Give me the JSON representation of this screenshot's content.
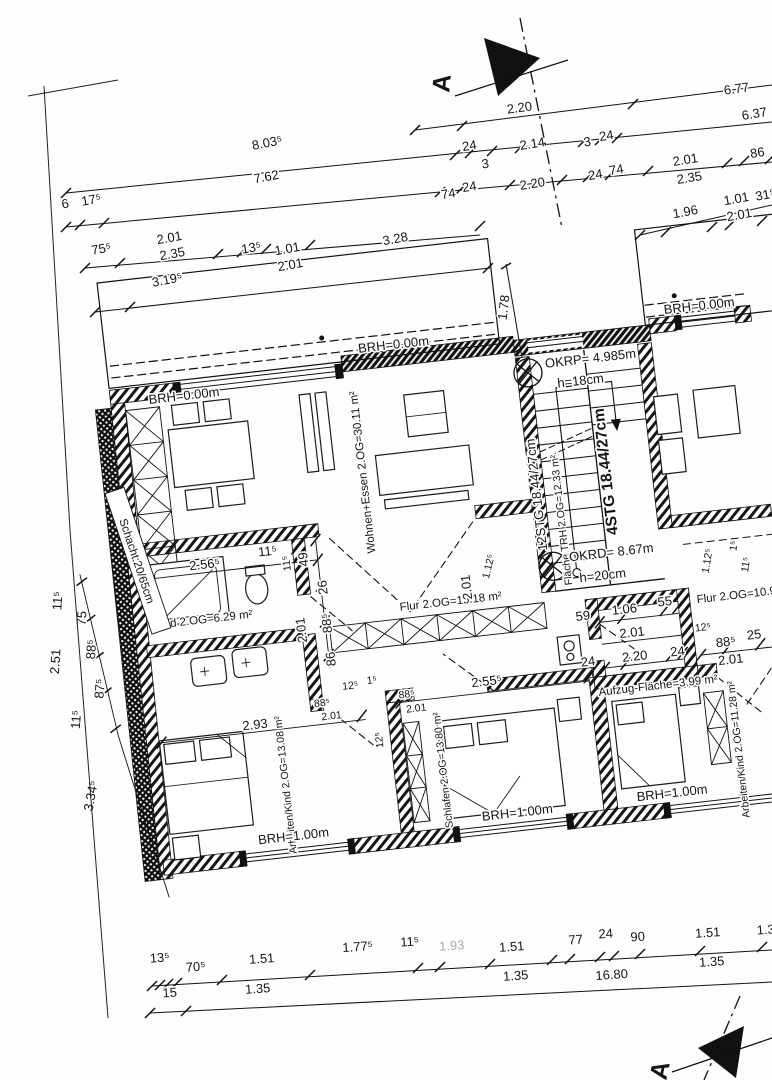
{
  "sheet": {
    "type": "floor-plan-scan",
    "floor": "2.OG",
    "section_marker_top": "A",
    "section_marker_bottom": "A",
    "rooms": {
      "wohnen": "Wohnen+Essen 2.OG=30.11 m²",
      "bad": "Bad 2.OG=6.29 m²",
      "flur": "Flur 2.OG=15.18 m²",
      "trh": "Fläche TRH 2.OG=12.33 m²",
      "aufzug": "Aufzug-Fläche=3.99 m²",
      "flur_r": "Flur 2.OG=10.98",
      "arbeiten_l": "Arbeiten/Kind 2.OG=13.08 m²",
      "schlafen": "Schlafen 2.OG=13.80 m²",
      "arbeiten_r": "Arbeiten/Kind 2.OG=11.28 m²"
    },
    "stairs": {
      "run_main": "12STG 18.44/27cm",
      "run_upper": "4STG 18.44/27cm",
      "okrp": "OKRP= 4.985m",
      "okrp_h": "h=18cm",
      "okrd": "OKRD= 8.67m",
      "okrd_h": "h=20cm"
    },
    "labels": {
      "schacht": "Schacht:20/65cm",
      "brh0": "BRH=0.00m",
      "brh1": "BRH=1.00m"
    },
    "dims": {
      "top": [
        "2.20",
        "6.77",
        "8.03⁵",
        "24",
        "2.14",
        "3",
        "24",
        "6.37",
        "6",
        "17⁵",
        "7.62",
        "3",
        "74",
        "24",
        "2.20",
        "24",
        "74",
        "2.01",
        "2.35",
        "86",
        "75⁵",
        "2.01",
        "2.35",
        "13⁵",
        "1.01",
        "2.01",
        "3.28",
        "1.96",
        "1.01",
        "2.01",
        "31⁵",
        "3.19⁵",
        "1.78"
      ],
      "left": [
        "11⁵",
        "75",
        "88⁵",
        "87⁵",
        "11⁵",
        "2.51",
        "3.34⁵"
      ],
      "bottom": [
        "13⁵",
        "70⁵",
        "1.51",
        "1.35",
        "1.77⁵",
        "11⁵",
        "1.93",
        "1.51",
        "1.35",
        "77",
        "24",
        "90",
        "1.51",
        "1.35",
        "1.3",
        "15",
        "16.80"
      ],
      "inner": [
        "2.56⁵",
        "11⁵",
        "49",
        "11⁵",
        "26",
        "88⁵",
        "86",
        "2.01",
        "2.01",
        "1.12⁵",
        "2.55⁵",
        "2.93",
        "88⁵",
        "2.01",
        "12⁵",
        "1⁵",
        "88⁵",
        "2.01",
        "12⁵",
        "59",
        "1.06",
        "55",
        "2.01",
        "24",
        "2.20",
        "24",
        "12⁵",
        "88⁵",
        "25",
        "2.01",
        "1.12⁵",
        "11⁵",
        "1⁵"
      ]
    }
  }
}
